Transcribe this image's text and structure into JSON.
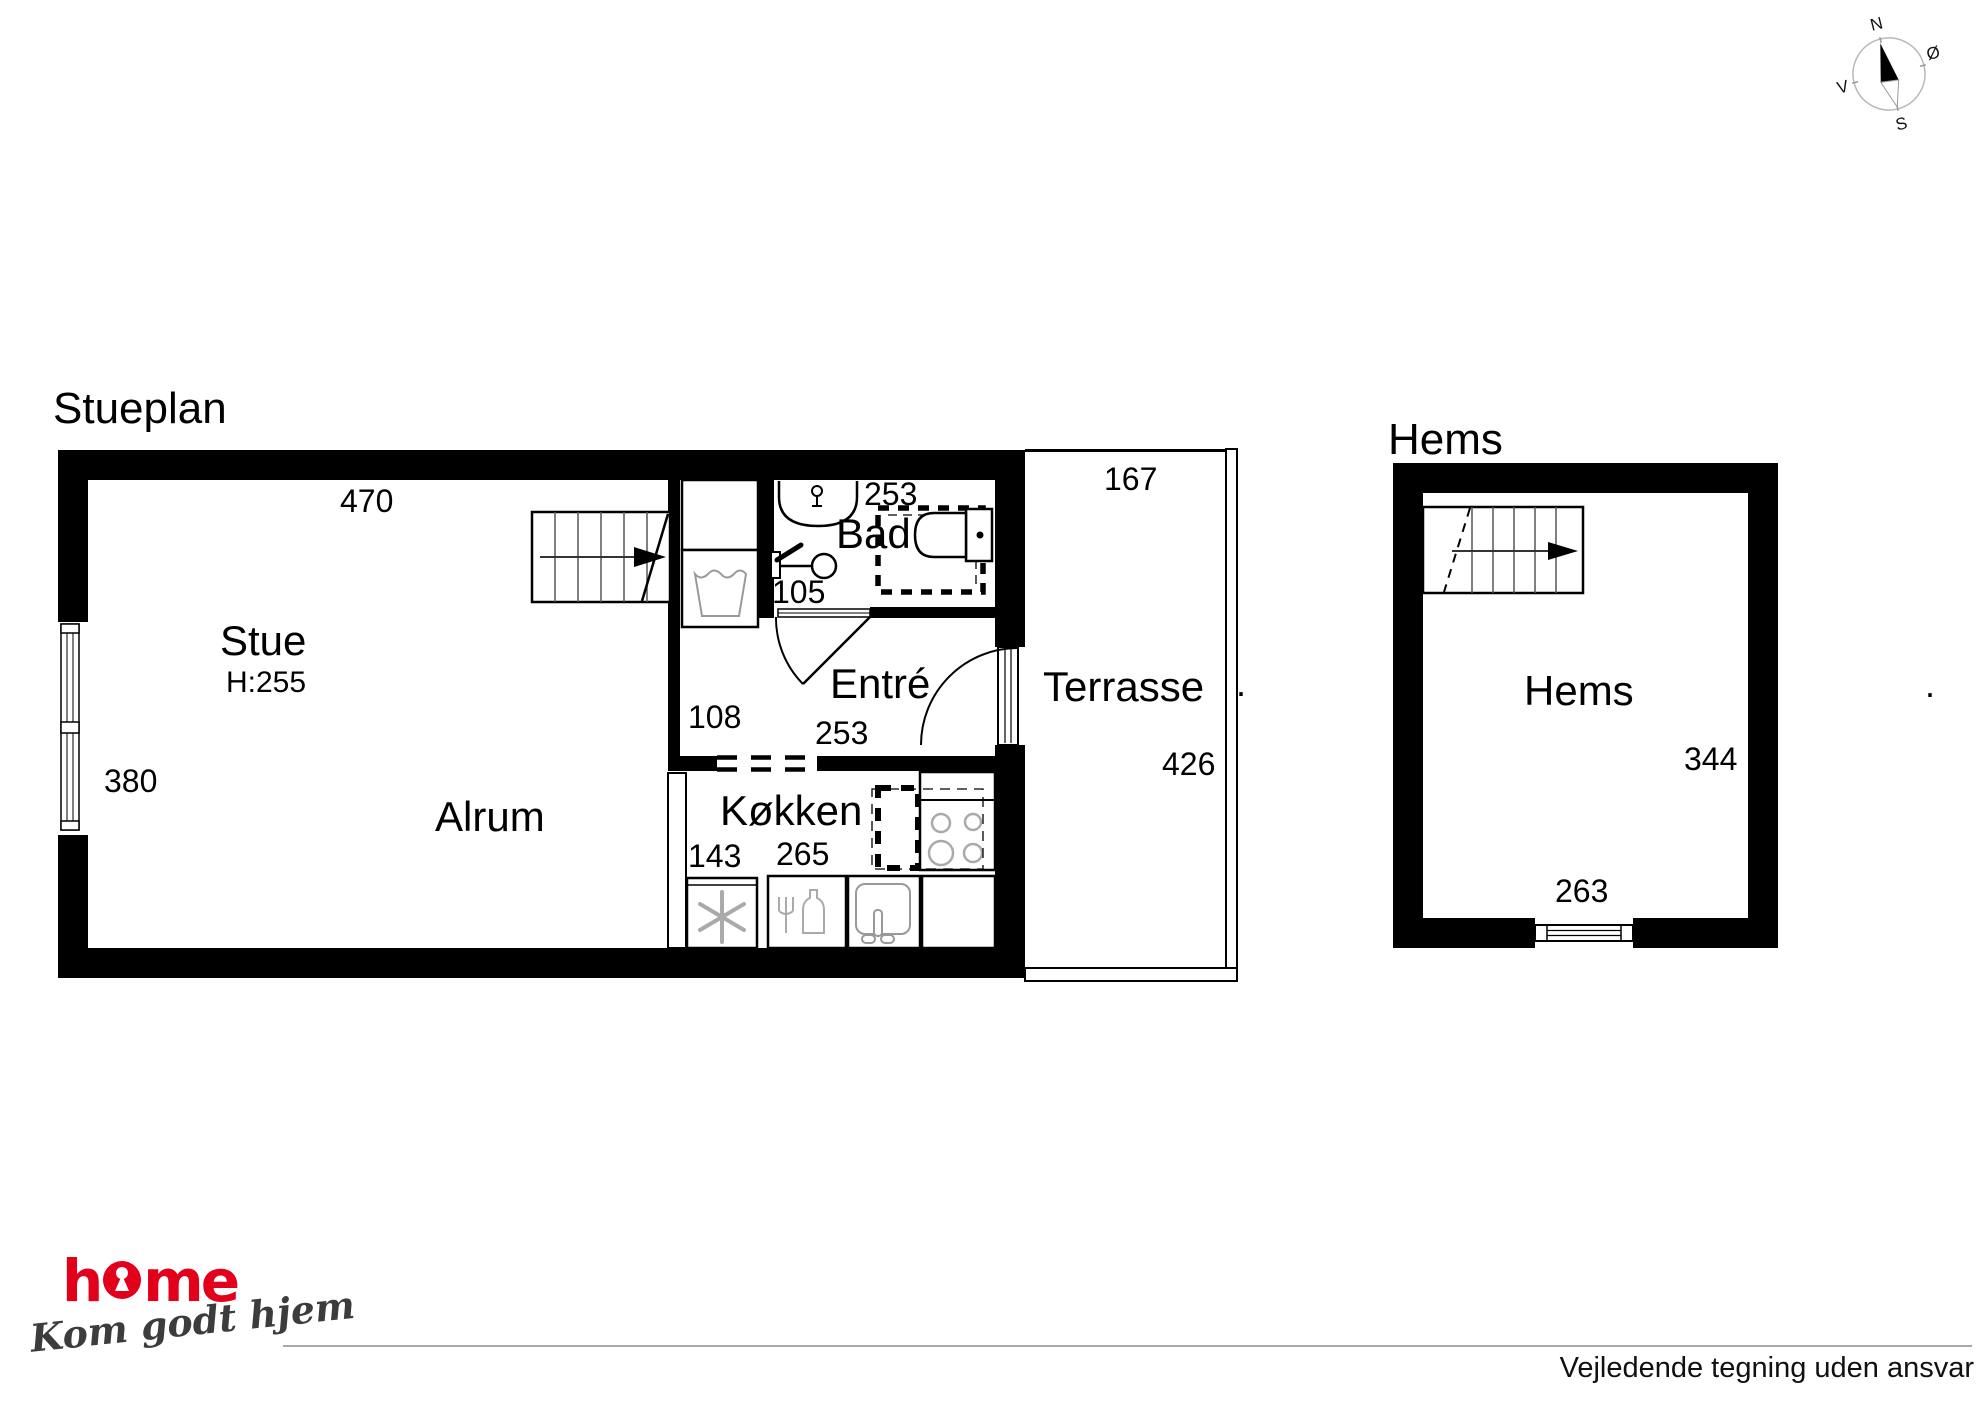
{
  "compass": {
    "north": "N",
    "east": "Ø",
    "south": "S",
    "west": "V"
  },
  "ground_floor": {
    "title": "Stueplan",
    "stue": {
      "label": "Stue",
      "ceiling_height": "H:255",
      "top_width": "470",
      "left_height": "380"
    },
    "alrum": {
      "label": "Alrum"
    },
    "bad": {
      "label": "Bad",
      "width": "253",
      "side": "105"
    },
    "entre": {
      "label": "Entré",
      "height": "108",
      "width": "253"
    },
    "kokken": {
      "label": "Køkken",
      "left_width": "143",
      "width": "265"
    },
    "terrasse": {
      "label": "Terrasse",
      "top_width": "167",
      "side_height": "426"
    }
  },
  "loft": {
    "title": "Hems",
    "hems": {
      "label": "Hems",
      "side_height": "344",
      "bottom_width": "263"
    }
  },
  "footer": {
    "logo_text": "home",
    "logo_part1": "h",
    "logo_part2": "me",
    "logo_color": "#e2001a",
    "tagline": "Kom godt hjem",
    "disclaimer": "Vejledende tegning uden ansvar"
  },
  "marks": {
    "period": "."
  }
}
